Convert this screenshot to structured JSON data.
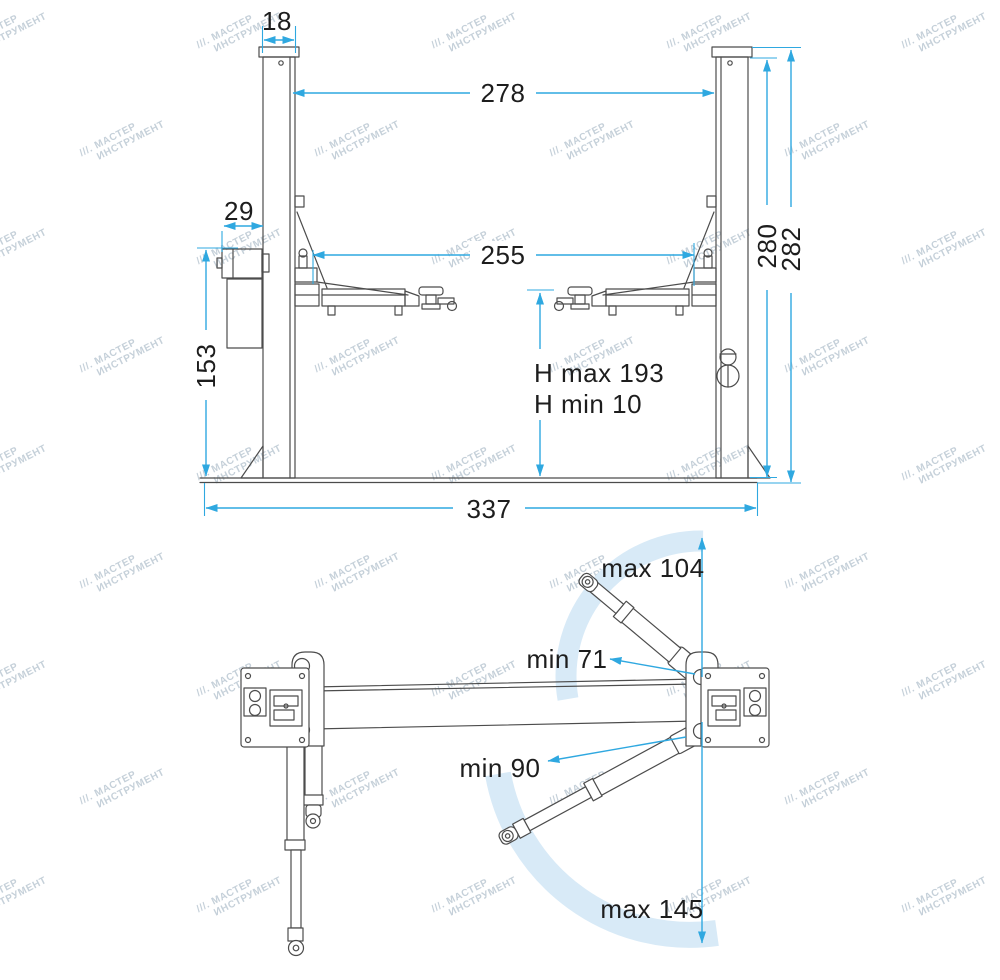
{
  "watermark": {
    "prefix": "///.",
    "line1": "МАСТЕР",
    "line2": "ИНСТРУМЕНТ"
  },
  "colors": {
    "dimension": "#2fa8e0",
    "arc_band": "#d8eaf7",
    "drawing_line": "#4c4c4c",
    "label_text": "#1d1d1d"
  },
  "front_view": {
    "dims": {
      "col_width": "18",
      "span_inner": "278",
      "motor_width": "29",
      "arm_span": "255",
      "col_height": "280",
      "total_height": "282",
      "motor_height": "153",
      "h_max": "H max 193",
      "h_min": "H min 10",
      "base_width": "337"
    }
  },
  "top_view": {
    "labels": {
      "front_arm_max": "max 104",
      "front_arm_min": "min 71",
      "rear_arm_min": "min 90",
      "rear_arm_max": "max 145"
    }
  }
}
